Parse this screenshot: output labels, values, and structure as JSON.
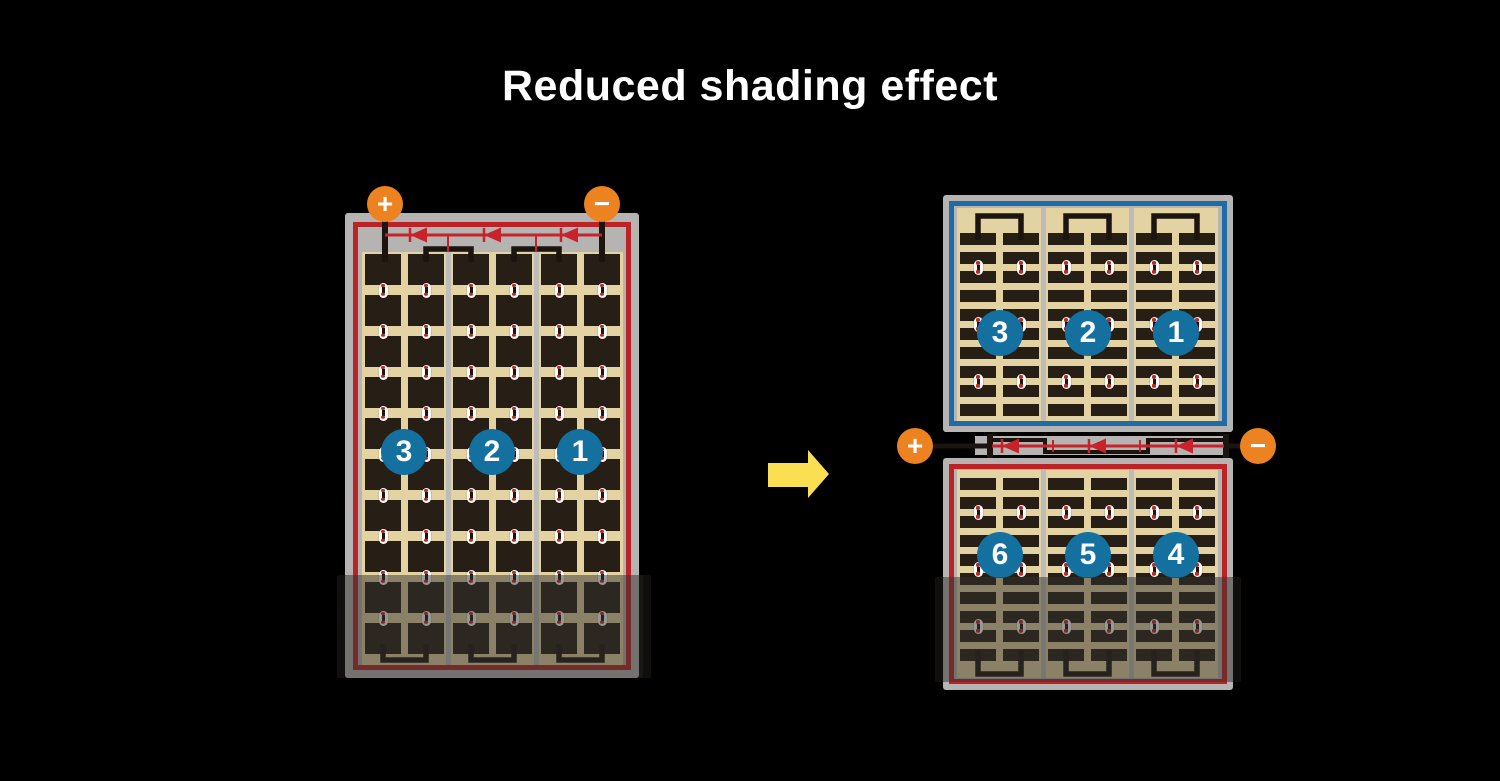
{
  "page": {
    "title": "Reduced shading effect"
  },
  "colors": {
    "background": "#000000",
    "title_text": "#ffffff",
    "panel_frame_gray": "#b5b4b2",
    "divider_gray": "#bdbcb9",
    "cell_area_tan": "#e3d3a2",
    "cell_dark_brown": "#271e15",
    "module_border_red": "#bb2426",
    "module_border_blue": "#1e6ca3",
    "bus_diode_red": "#c8232a",
    "terminal_orange": "#ec8320",
    "string_badge_blue": "#13709f",
    "arrow_yellow": "#fadf52",
    "wire_black": "#1c140e",
    "pill_dot_red": "#bb2a22",
    "shade_overlay": "rgba(50,48,44,0.5)"
  },
  "left_module": {
    "terminals": {
      "positive": "+",
      "negative": "−"
    },
    "strings": [
      {
        "label": "3"
      },
      {
        "label": "2"
      },
      {
        "label": "1"
      }
    ]
  },
  "right_module": {
    "terminals": {
      "positive": "+",
      "negative": "−"
    },
    "top_strings": [
      {
        "label": "3"
      },
      {
        "label": "2"
      },
      {
        "label": "1"
      }
    ],
    "bottom_strings": [
      {
        "label": "6"
      },
      {
        "label": "5"
      },
      {
        "label": "4"
      }
    ]
  }
}
